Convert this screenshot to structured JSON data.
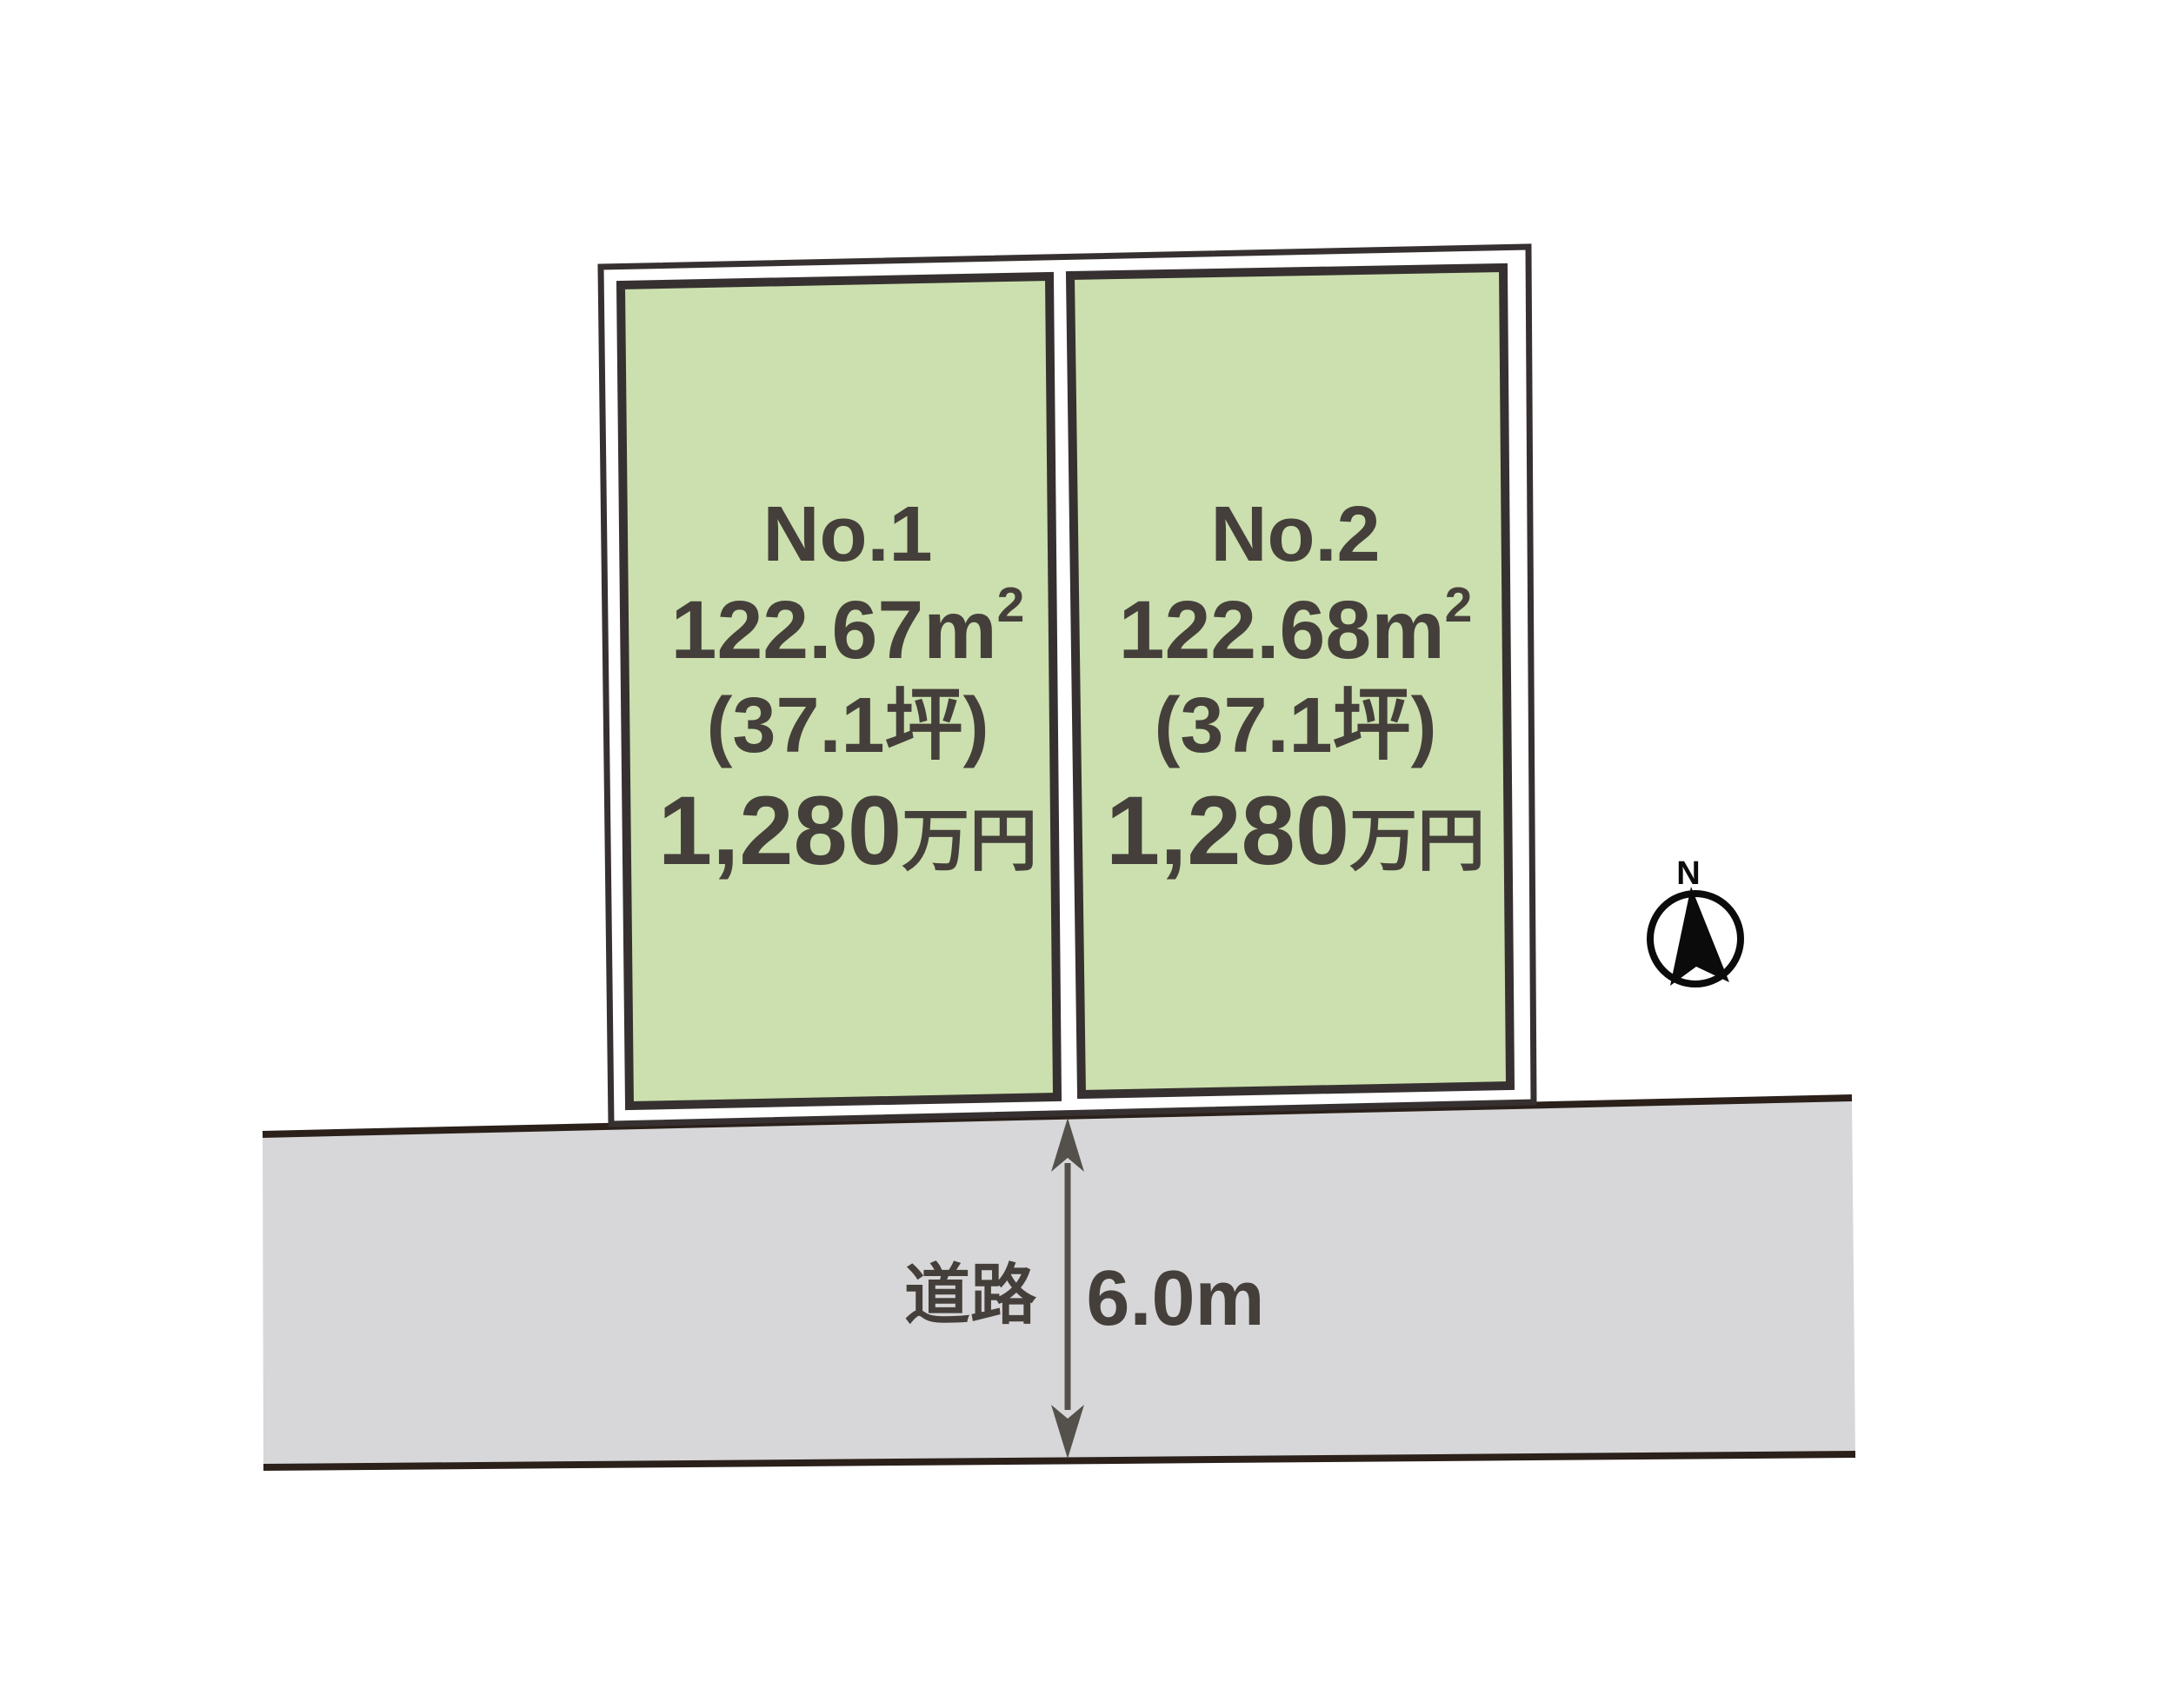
{
  "diagram": {
    "lots": [
      {
        "name": "No.1",
        "area_value": "122.67",
        "area_unit": "m",
        "area_exponent": "2",
        "area_tsubo": "(37.1坪)",
        "price_value": "1,280",
        "price_unit": "万円"
      },
      {
        "name": "No.2",
        "area_value": "122.68",
        "area_unit": "m",
        "area_exponent": "2",
        "area_tsubo": "(37.1坪)",
        "price_value": "1,280",
        "price_unit": "万円"
      }
    ],
    "road": {
      "label": "道路",
      "width_label": "6.0m"
    },
    "compass": {
      "north_label": "N"
    },
    "colors": {
      "lot_fill": "#cbe0ae",
      "outline": "#363130",
      "road_fill": "#d7d7d9",
      "road_line": "#2b201a",
      "text": "#453f3b",
      "arrow": "#54504b",
      "compass": "#0b0b0b"
    }
  }
}
